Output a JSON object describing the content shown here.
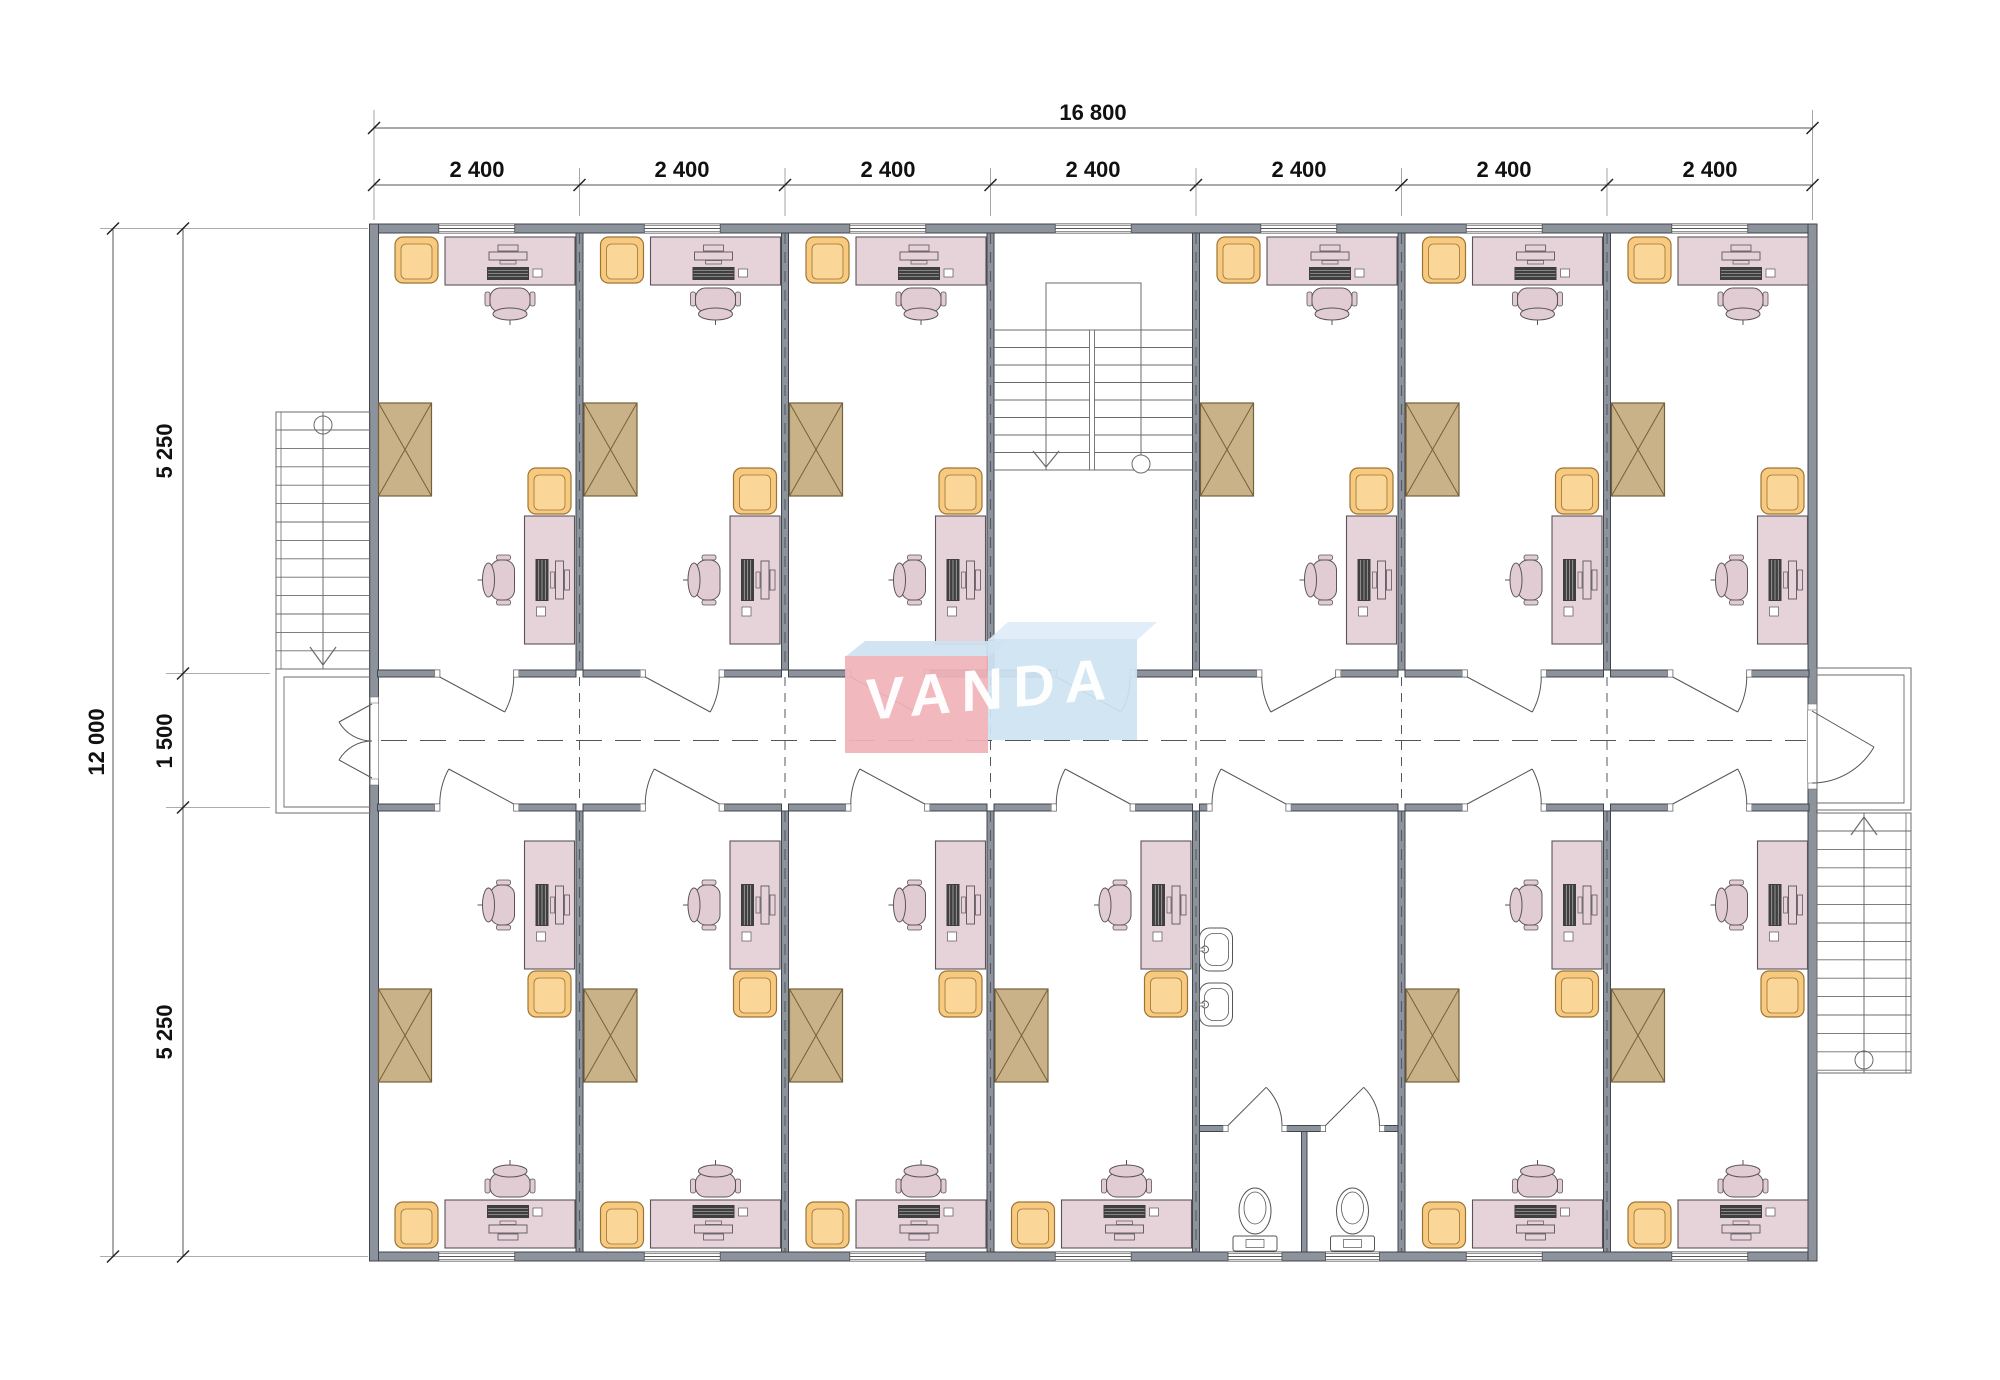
{
  "dimensions": {
    "total_width": "16 800",
    "modules": [
      "2 400",
      "2 400",
      "2 400",
      "2 400",
      "2 400",
      "2 400",
      "2 400"
    ],
    "total_height": "12 000",
    "rows": [
      "5 250",
      "1 500",
      "5 250"
    ]
  },
  "logo": {
    "text": "VANDA",
    "left_box_color": "#f0b3b9",
    "left_top_color": "#cfe2f0",
    "right_box_color": "#cfe3f2",
    "right_top_color": "#dfecf8",
    "text_color": "#ffffff"
  },
  "palette": {
    "wall_fill": "#8d939c",
    "wall_stroke": "#41454c",
    "line": "#555555",
    "thin_line": "#6b6b6b",
    "ext_line": "#909090",
    "tick": "#222222",
    "desk_fill": "#e6d3d9",
    "desk_stroke": "#5a545a",
    "chair_fill": "#e2ccd3",
    "armchair_fill": "#f8ca80",
    "armchair_inner": "#fad698",
    "armchair_stroke": "#9c7434",
    "cabinet_fill": "#c9b287",
    "cabinet_stroke": "#76603a",
    "keyboard_fill": "#3f3f3f",
    "fixture_fill": "#ffffff",
    "paper": "#ffffff"
  },
  "plan": {
    "module_count": 7,
    "top_row": [
      "office",
      "office",
      "office",
      "stairwell",
      "office",
      "office",
      "office"
    ],
    "bottom_row": [
      "office",
      "office",
      "office",
      "office",
      "washroom",
      "office",
      "office"
    ],
    "top_door_hinges": [
      "L",
      "L",
      "L",
      "L",
      "R",
      "L",
      "L"
    ],
    "bottom_door_hinges": [
      "R",
      "R",
      "R",
      "R",
      "R",
      "L",
      "L"
    ],
    "exterior_stairs": [
      "left",
      "right"
    ],
    "washroom_fixtures": {
      "sinks": 2,
      "toilets": 2,
      "stalls": 2
    }
  }
}
